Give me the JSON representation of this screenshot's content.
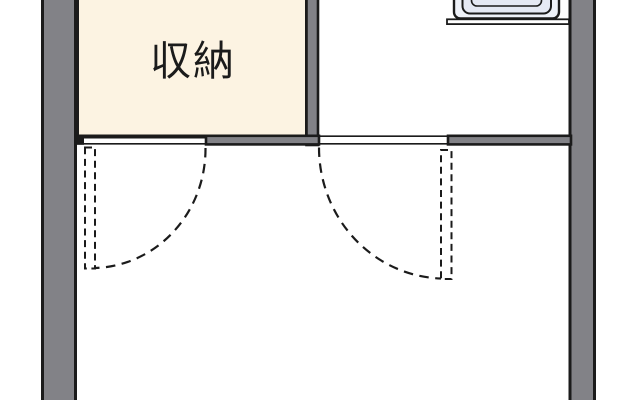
{
  "plan": {
    "kind": "floor-plan",
    "labels": {
      "storage_room": "収納"
    },
    "fixtures": {
      "sink": "kitchen-sink",
      "counter": "kitchen-counter"
    },
    "doors": {
      "left": "hinged-door-dashed-swing",
      "right": "hinged-door-dashed-swing"
    },
    "colors": {
      "background": "#ffffff",
      "wall_fill": "#828287",
      "line": "#1b1b1b",
      "storage_fill": "#fcf3e2",
      "sink_outer_fill": "#eef1f8",
      "sink_basin_fill": "#e5e9f4"
    }
  }
}
